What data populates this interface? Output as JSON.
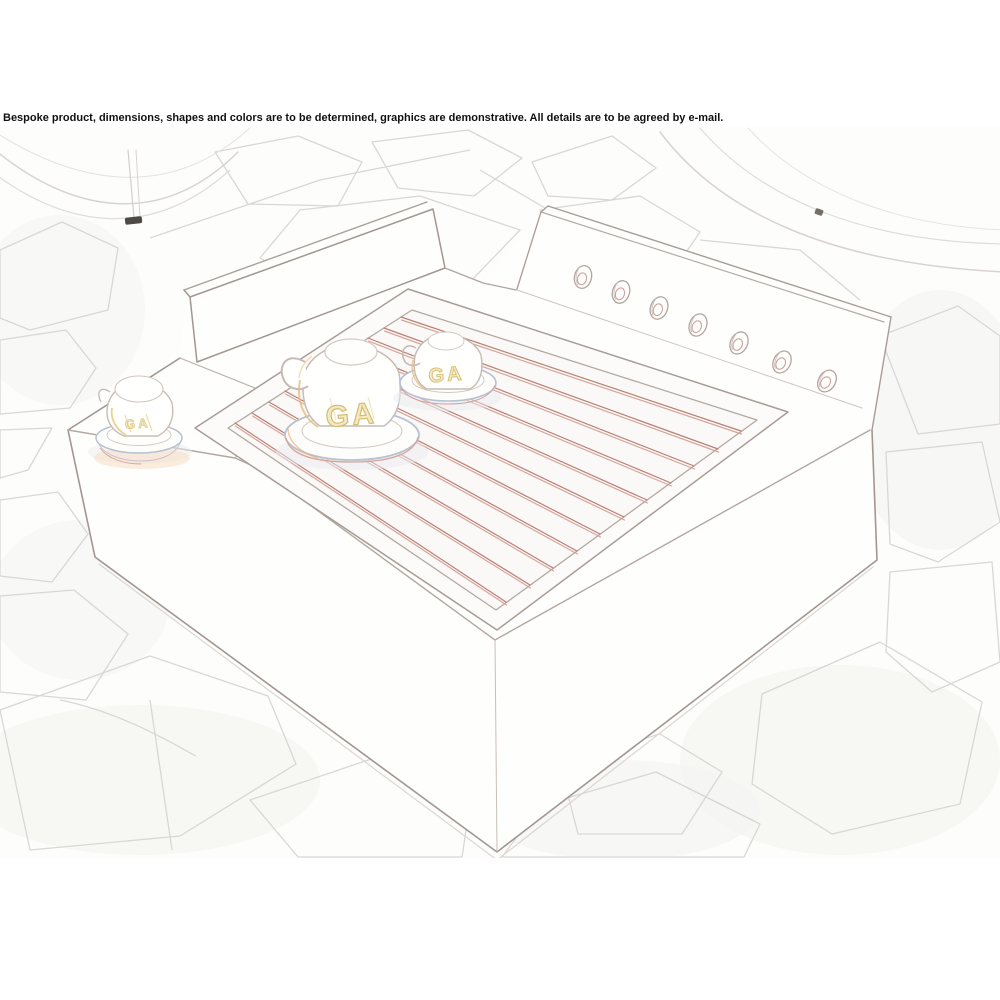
{
  "disclaimer": "Bespoke product, dimensions, shapes and colors are to be determined, graphics are demonstrative. All details are to be agreed by e-mail.",
  "scene": {
    "description": "Faint pencil-sketch style concept render of a bespoke cup-warmer box on a flagstone patio: recessed tray with red heating rods, back rail with seven knobs, three upturned monogrammed espresso cups, planters in top corners",
    "monogram": "GA",
    "rod_count": 11,
    "knob_count": 7,
    "cup_count": 3
  },
  "colors": {
    "background": "#ffffff",
    "text": "#111111",
    "sketch_line": "#a29790",
    "rod_red": "#b97f74",
    "monogram_yellow": "#d3ba69",
    "stone_line": "#d7d6d4",
    "saucer_blue": "#b7c1d4",
    "warm_accent": "#e7bb80"
  }
}
